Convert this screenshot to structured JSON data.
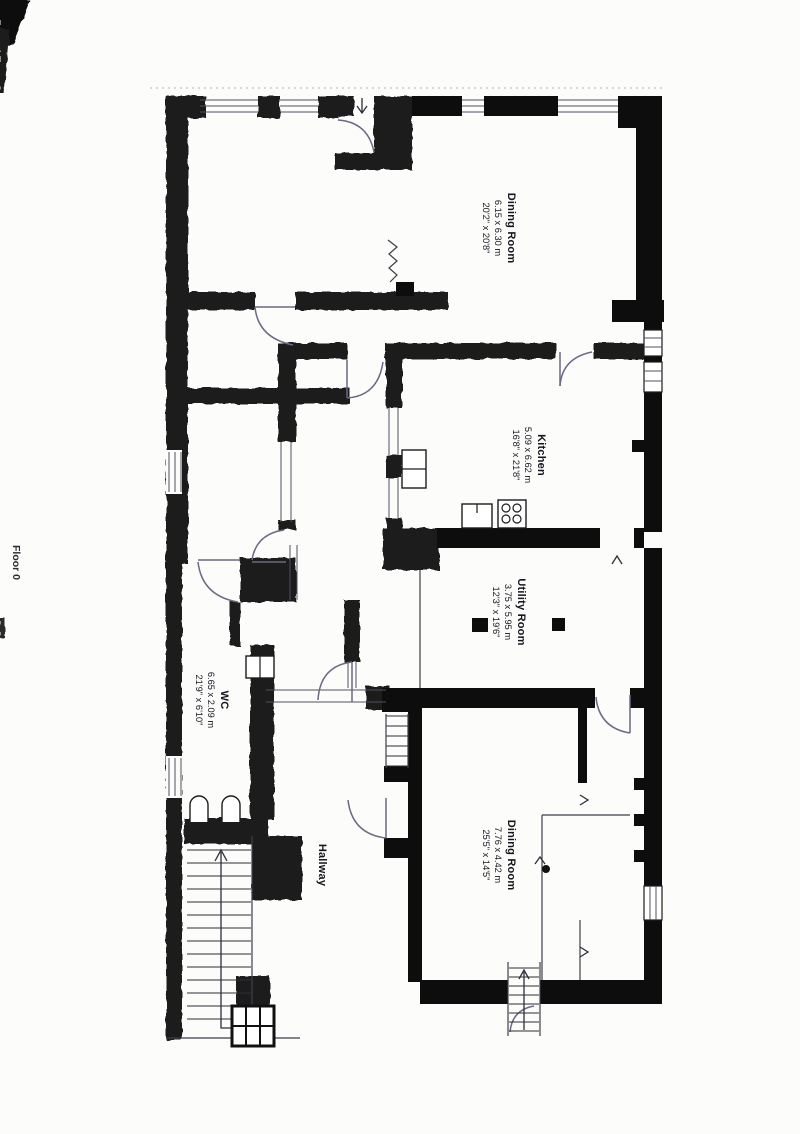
{
  "document": {
    "floor_label": "Floor 0"
  },
  "rooms": [
    {
      "id": "dining-room-1",
      "name": "Dining Room",
      "dimensions_m": "6.15 x 6.30 m",
      "dimensions_ft": "20'2\" x 20'8\""
    },
    {
      "id": "kitchen",
      "name": "Kitchen",
      "dimensions_m": "5.09 x 6.62 m",
      "dimensions_ft": "16'8\" x 21'8\""
    },
    {
      "id": "utility-room",
      "name": "Utility Room",
      "dimensions_m": "3.75 x 5.95 m",
      "dimensions_ft": "12'3\" x 19'6\""
    },
    {
      "id": "wc",
      "name": "WC",
      "dimensions_m": "6.65 x 2.09 m",
      "dimensions_ft": "21'9\" x 6'10\""
    },
    {
      "id": "dining-room-2",
      "name": "Dining Room",
      "dimensions_m": "7.76 x 4.42 m",
      "dimensions_ft": "25'5\" x 14'5\""
    },
    {
      "id": "hallway",
      "name": "Hallway",
      "dimensions_m": "",
      "dimensions_ft": ""
    }
  ],
  "colors": {
    "wall": "#0d0d0d",
    "pencil_wall": "#1d1d1d",
    "door_arc": "#6a6a85",
    "thin_line": "#3d3d48",
    "window_line": "#51515f",
    "label_text": "#15151f",
    "paper": "#fcfcfa"
  }
}
